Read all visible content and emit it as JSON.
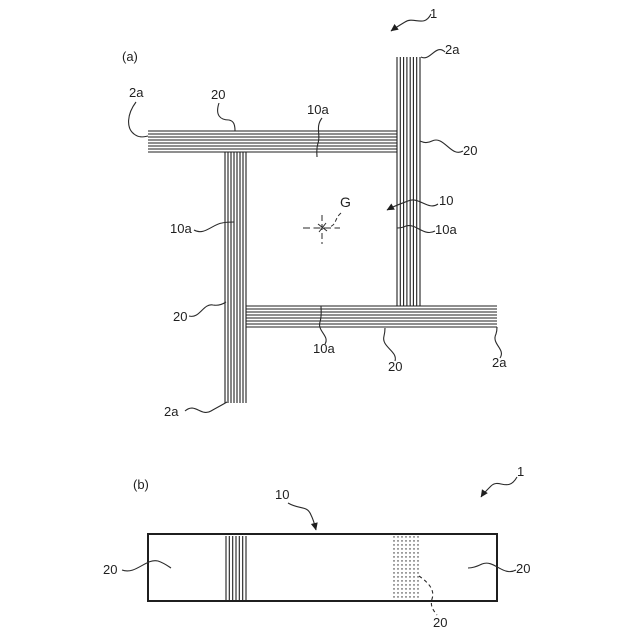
{
  "panel_a": {
    "label": "(a)",
    "assembly_ref": "1",
    "member_ref": "10",
    "gravity_center": "G",
    "bars": {
      "top": "20",
      "right": "20",
      "left": "20",
      "bottom": "20"
    },
    "faces": {
      "top": "10a",
      "left": "10a",
      "right": "10a",
      "bottom": "10a"
    },
    "corners": {
      "top_left": "2a",
      "top_right": "2a",
      "bottom_left": "2a",
      "bottom_right": "2a"
    }
  },
  "panel_b": {
    "label": "(b)",
    "assembly_ref": "1",
    "member_ref": "10",
    "bars": {
      "left": "20",
      "right": "20",
      "hidden": "20"
    }
  },
  "colors": {
    "line": "#1f1f1f",
    "background": "#ffffff"
  }
}
